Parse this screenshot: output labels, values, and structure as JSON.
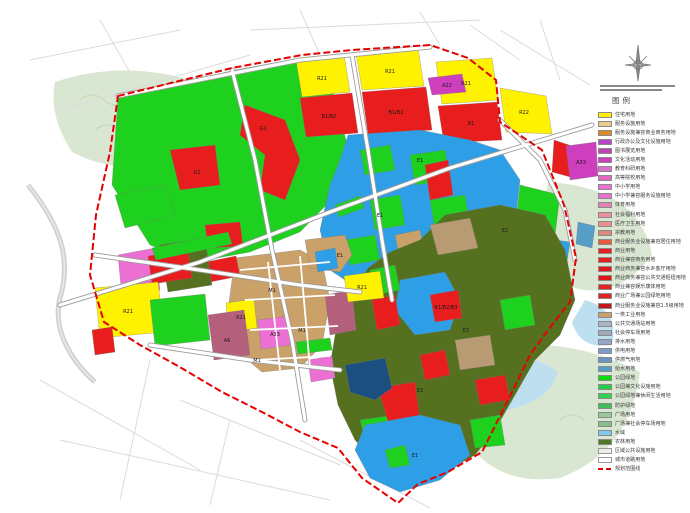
{
  "page": {
    "background": "#FFFFFF"
  },
  "compass": {
    "icon": "north-arrow"
  },
  "legend": {
    "title": "图例",
    "items": [
      {
        "label": "住宅用地",
        "color": "#FFF200",
        "style": "fill"
      },
      {
        "label": "服务设施用地",
        "color": "#E6CE8A",
        "style": "fill"
      },
      {
        "label": "服务设施兼容商业商务用地",
        "color": "#D98A2B",
        "style": "fill"
      },
      {
        "label": "行政办公及文化设施用地",
        "color": "#B845C8",
        "style": "fill"
      },
      {
        "label": "图书展览用地",
        "color": "#C23FB4",
        "style": "fill"
      },
      {
        "label": "文化活动用地",
        "color": "#CE3FBE",
        "style": "fill"
      },
      {
        "label": "教育科研用地",
        "color": "#DC6ECD",
        "style": "fill"
      },
      {
        "label": "高等院校用地",
        "color": "#E06AC4",
        "style": "fill"
      },
      {
        "label": "中小学用地",
        "color": "#EC6FD4",
        "style": "fill"
      },
      {
        "label": "中小学兼容服务设施用地",
        "color": "#EC6FD4",
        "style": "fill"
      },
      {
        "label": "体育用地",
        "color": "#E680B8",
        "style": "fill"
      },
      {
        "label": "社会福利用地",
        "color": "#EE8FA0",
        "style": "fill"
      },
      {
        "label": "医疗卫生用地",
        "color": "#EF8E8E",
        "style": "fill"
      },
      {
        "label": "宗教用地",
        "color": "#DE8A7B",
        "style": "fill"
      },
      {
        "label": "商业服务业设施兼容居住用地",
        "color": "#EA5B3C",
        "style": "fill"
      },
      {
        "label": "商业用地",
        "color": "#E81E1E",
        "style": "fill"
      },
      {
        "label": "商业兼容商务用地",
        "color": "#E81E1E",
        "style": "fill"
      },
      {
        "label": "商业商务兼容水乡客厅用地",
        "color": "#DF1616",
        "style": "fill"
      },
      {
        "label": "商业商务兼容公共交通枢纽用地",
        "color": "#DF1616",
        "style": "fill"
      },
      {
        "label": "商业兼容娱乐康体用地",
        "color": "#E32222",
        "style": "fill"
      },
      {
        "label": "商业广场兼公园绿地用地",
        "color": "#E32222",
        "style": "fill"
      },
      {
        "label": "商业服务业设施兼容1.5级用地",
        "color": "#C01818",
        "style": "fill"
      },
      {
        "label": "一类工业用地",
        "color": "#C9A169",
        "style": "fill"
      },
      {
        "label": "公共交通场站用地",
        "color": "#AAB4C8",
        "style": "fill"
      },
      {
        "label": "社会停车场用地",
        "color": "#9FA8BC",
        "style": "fill"
      },
      {
        "label": "排水用地",
        "color": "#93A8C6",
        "style": "fill"
      },
      {
        "label": "供电用地",
        "color": "#7D9CCB",
        "style": "fill"
      },
      {
        "label": "供燃气用地",
        "color": "#6A93C5",
        "style": "fill"
      },
      {
        "label": "给水用地",
        "color": "#569DC8",
        "style": "fill"
      },
      {
        "label": "公园绿地",
        "color": "#0ADD0A",
        "style": "fill"
      },
      {
        "label": "公园兼文化设施用地",
        "color": "#23CE4A",
        "style": "fill"
      },
      {
        "label": "公园绿地兼休闲生活用地",
        "color": "#2FD153",
        "style": "fill"
      },
      {
        "label": "防护绿地",
        "color": "#3FBF5A",
        "style": "fill"
      },
      {
        "label": "广场用地",
        "color": "#98C89A",
        "style": "fill"
      },
      {
        "label": "广场兼社会停车场用地",
        "color": "#88BE8C",
        "style": "fill"
      },
      {
        "label": "水域",
        "color": "#7FC9EC",
        "style": "fill"
      },
      {
        "label": "农林用地",
        "color": "#4F7A23",
        "style": "fill"
      },
      {
        "label": "区域公共设施用地",
        "color": "#EDEDE3",
        "style": "outline"
      },
      {
        "label": "城市道路用地",
        "color": "#FFFFFF",
        "style": "outline"
      },
      {
        "label": "规划范围线",
        "color": "#E60000",
        "style": "dash"
      }
    ]
  },
  "map": {
    "boundary_color": "#E60000",
    "labels": [
      {
        "text": "G1",
        "x": 197,
        "y": 174
      },
      {
        "text": "G1",
        "x": 263,
        "y": 130
      },
      {
        "text": "R21",
        "x": 322,
        "y": 80
      },
      {
        "text": "R21",
        "x": 390,
        "y": 73
      },
      {
        "text": "R21",
        "x": 466,
        "y": 85
      },
      {
        "text": "R22",
        "x": 524,
        "y": 114
      },
      {
        "text": "B1/B2",
        "x": 329,
        "y": 118
      },
      {
        "text": "B1/B2",
        "x": 396,
        "y": 114
      },
      {
        "text": "B1",
        "x": 471,
        "y": 125
      },
      {
        "text": "A22",
        "x": 447,
        "y": 87
      },
      {
        "text": "E1",
        "x": 420,
        "y": 162
      },
      {
        "text": "E1",
        "x": 380,
        "y": 217
      },
      {
        "text": "E1",
        "x": 340,
        "y": 257
      },
      {
        "text": "A33",
        "x": 581,
        "y": 164
      },
      {
        "text": "E2",
        "x": 505,
        "y": 232
      },
      {
        "text": "E2",
        "x": 466,
        "y": 332
      },
      {
        "text": "E2",
        "x": 420,
        "y": 392
      },
      {
        "text": "E1",
        "x": 415,
        "y": 457
      },
      {
        "text": "B1/B2/B3",
        "x": 446,
        "y": 309
      },
      {
        "text": "M1",
        "x": 272,
        "y": 292
      },
      {
        "text": "M1",
        "x": 302,
        "y": 332
      },
      {
        "text": "M1",
        "x": 257,
        "y": 362
      },
      {
        "text": "R21",
        "x": 241,
        "y": 319
      },
      {
        "text": "A33",
        "x": 275,
        "y": 336
      },
      {
        "text": "A6",
        "x": 227,
        "y": 342
      },
      {
        "text": "R21",
        "x": 362,
        "y": 289,
        "color": "#CC0000"
      },
      {
        "text": "R21",
        "x": 128,
        "y": 313
      }
    ]
  }
}
